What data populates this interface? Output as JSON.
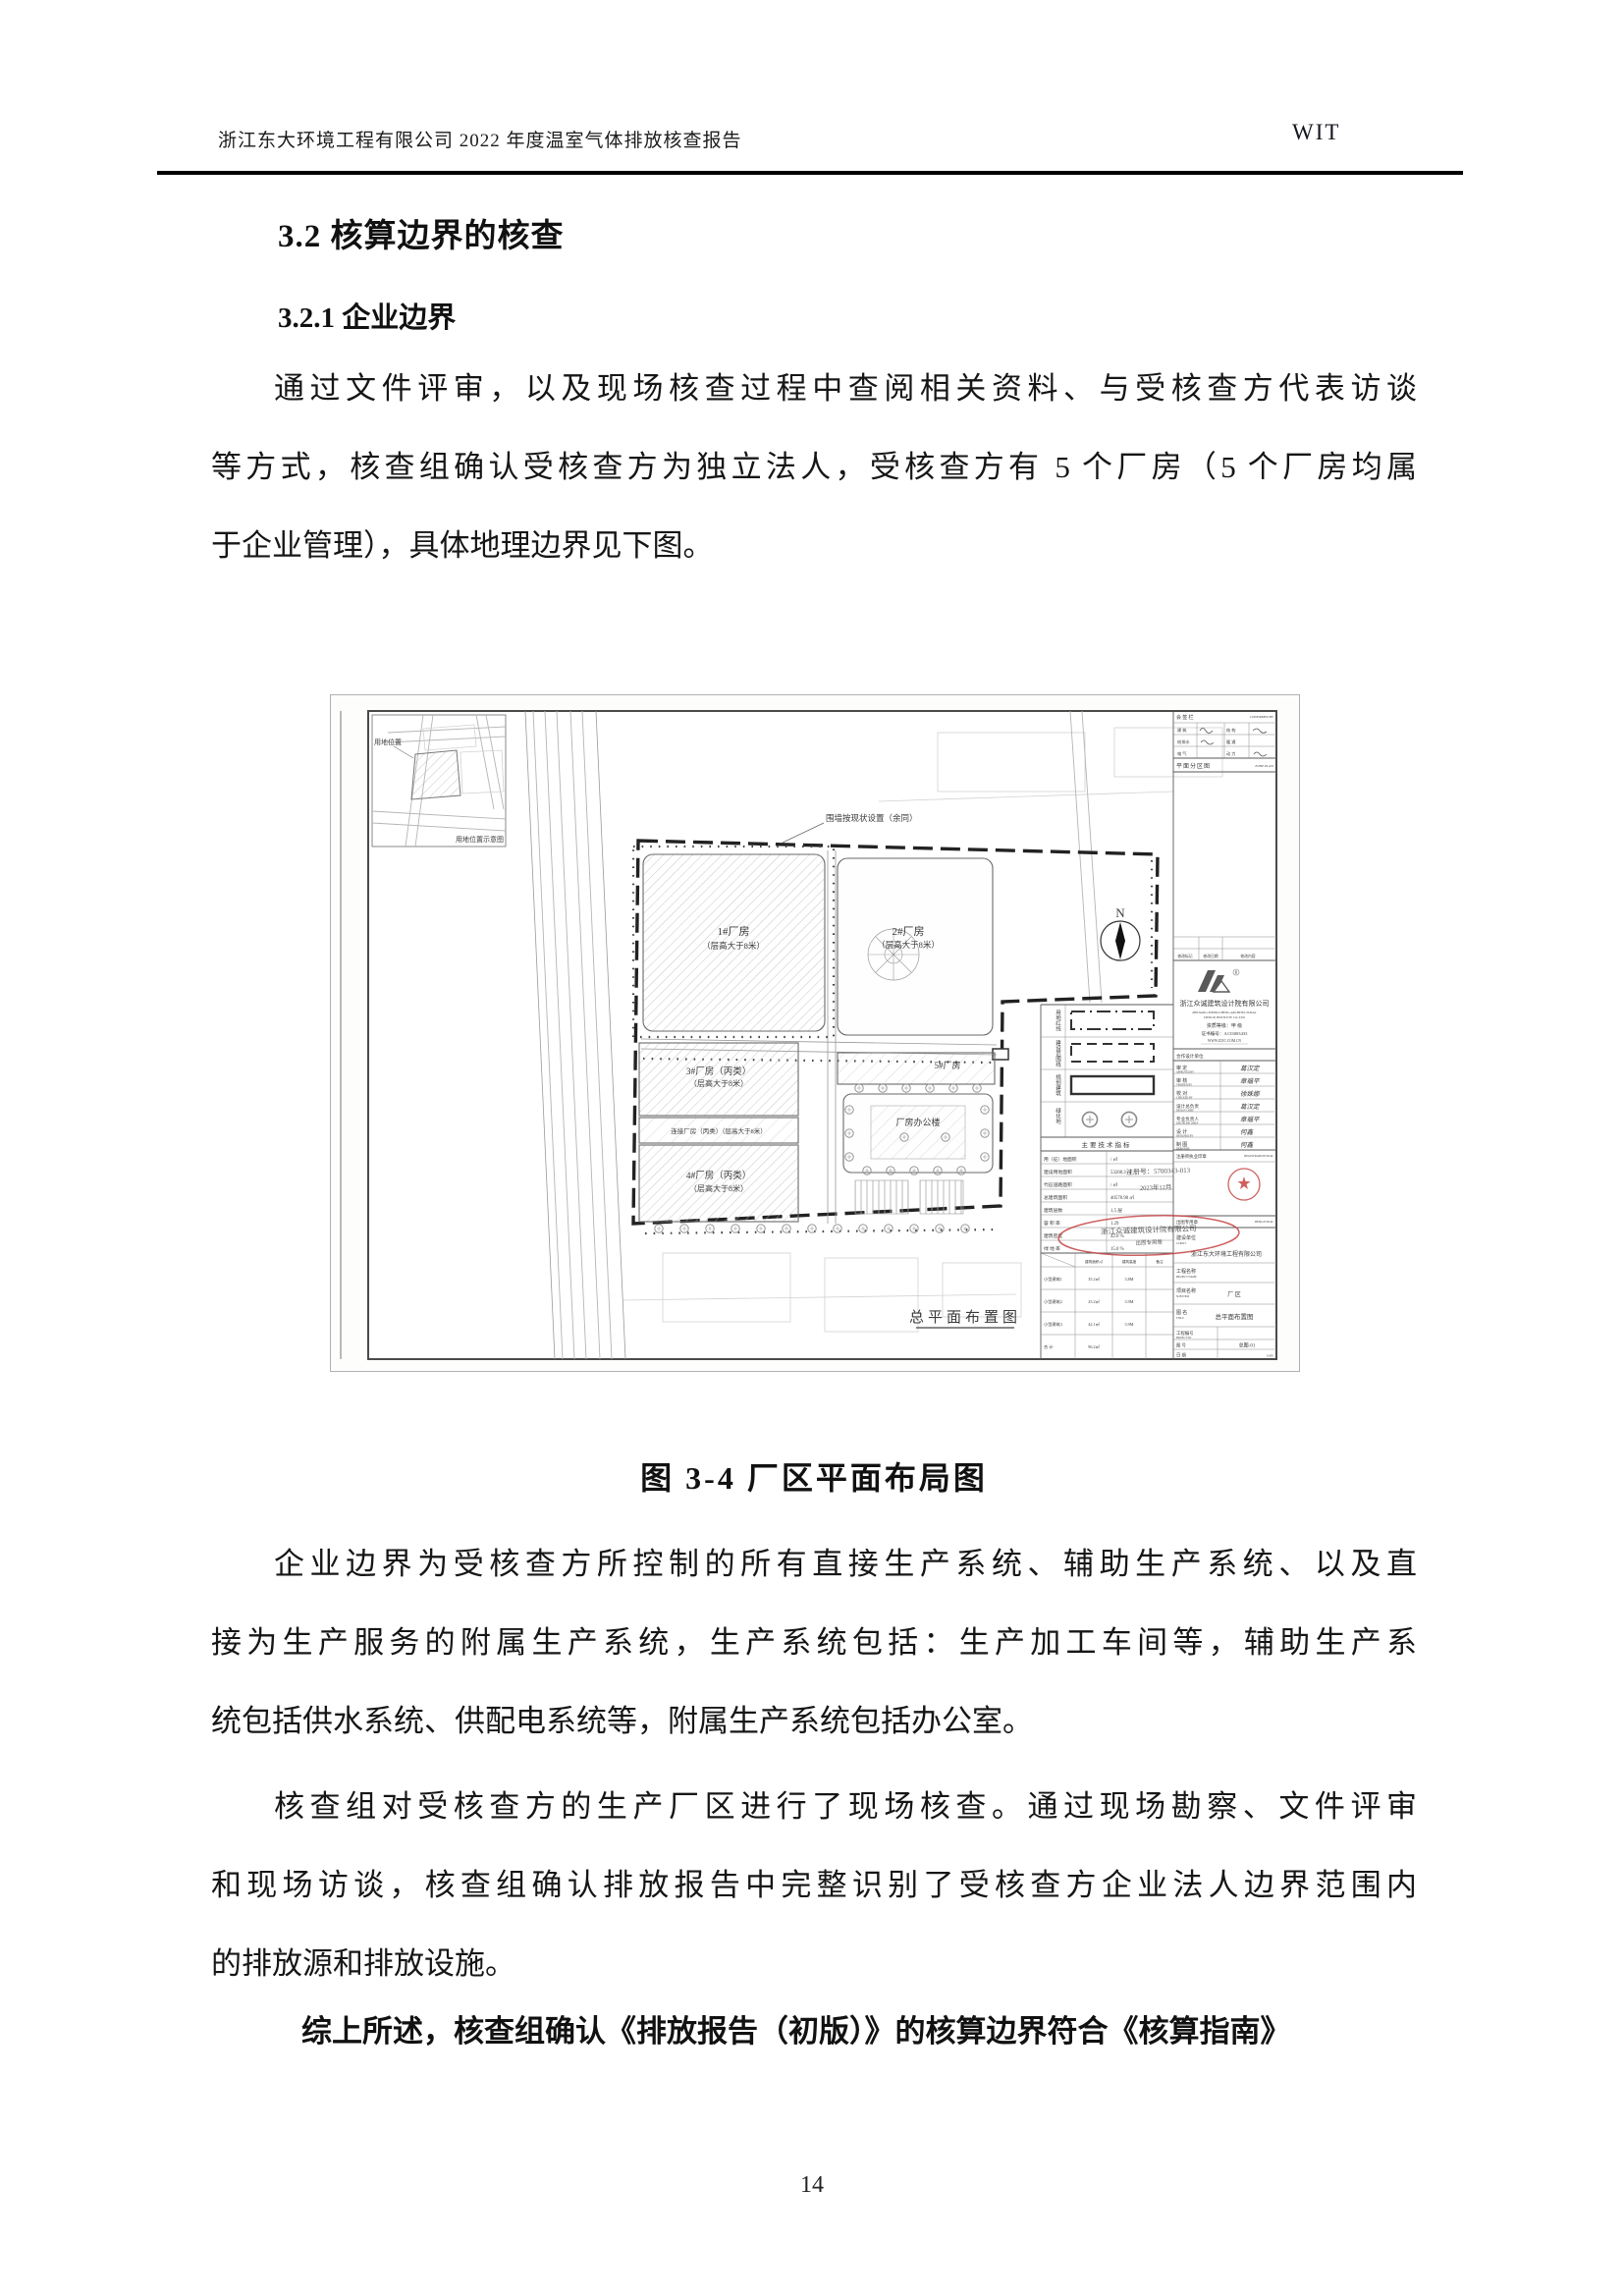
{
  "header": {
    "left": "浙江东大环境工程有限公司 2022 年度温室气体排放核查报告",
    "right": "WIT"
  },
  "sections": {
    "h1": "3.2 核算边界的核查",
    "h2": "3.2.1 企业边界"
  },
  "paragraphs": {
    "p1": [
      "通过文件评审，以及现场核查过程中查阅相关资料、与受核查方代表访谈",
      "等方式，核查组确认受核查方为独立法人，受核查方有 5 个厂房（5 个厂房均属",
      "于企业管理），具体地理边界见下图。"
    ],
    "caption": "图 3-4  厂区平面布局图",
    "p2": [
      "企业边界为受核查方所控制的所有直接生产系统、辅助生产系统、以及直",
      "接为生产服务的附属生产系统，生产系统包括：生产加工车间等，辅助生产系",
      "统包括供水系统、供配电系统等，附属生产系统包括办公室。"
    ],
    "p3": [
      "核查组对受核查方的生产厂区进行了现场核查。通过现场勘察、文件评审",
      "和现场访谈，核查组确认排放报告中完整识别了受核查方企业法人边界范围内",
      "的排放源和排放设施。"
    ],
    "p4": "综上所述，核查组确认《排放报告（初版）》的核算边界符合《核算指南》"
  },
  "page_number": "14",
  "figure": {
    "wall_note": "围墙按现状设置（余同）",
    "inset": {
      "label": "用地位置",
      "caption": "用地位置示意图"
    },
    "north": "N",
    "buildings": {
      "b1a": "1#厂房",
      "b1b": "（层高大于8米）",
      "b2a": "2#厂房",
      "b2b": "（层高大于8米）",
      "b3a": "3#厂房（丙类）",
      "b3b": "（层高大于8米）",
      "link": "连接厂房（丙类）（层高大于8米）",
      "b4a": "4#厂房（丙类）",
      "b4b": "（层高大于8米）",
      "b5": "5#厂房",
      "office": "厂房办公楼"
    },
    "plan_caption": "总平面布置图",
    "legend": [
      "用地红线",
      "建设范围线",
      "规划建筑",
      "绿化地"
    ],
    "tech_table": {
      "title": "主要技术指标",
      "rows": [
        [
          "用（征）地面积",
          "/ ㎡"
        ],
        [
          "建设用地面积",
          "53208.3 ㎡"
        ],
        [
          "代征道路面积",
          "/ ㎡"
        ],
        [
          "总建筑面积",
          "40578.98 ㎡"
        ],
        [
          "建筑层数",
          "1,5 层"
        ],
        [
          "容 积 率",
          "1.29"
        ],
        [
          "建筑密度",
          "42.6 %"
        ],
        [
          "绿 地 率",
          "15.0 %"
        ]
      ],
      "sub_header": [
        "建筑面积㎡",
        "建筑高度",
        "备注"
      ],
      "sub_rows": [
        [
          "小型建筑1",
          "35.2㎡",
          "3.8M"
        ],
        [
          "小型建筑2",
          "25.2㎡",
          "3.9M"
        ],
        [
          "小型建筑3",
          "42.1㎡",
          "3.9M"
        ],
        [
          "合 计",
          "96.2㎡",
          ""
        ]
      ]
    },
    "titleblock": {
      "confirm_cn": "会 签 栏",
      "confirm_en": "CONFIRMED BY",
      "grid": [
        "建 筑",
        "结 构",
        "给排水",
        "暖 通",
        "电 气",
        "动 力"
      ],
      "zone_cn": "平面分区图",
      "zone_en": "ZONE PLAN",
      "rev": [
        "修改标记",
        "修改日期",
        "修改内容"
      ],
      "company_cn": "浙江众诚建筑设计院有限公司",
      "company_en1": "ZHEJIANG ZHONGCHENG ARCHITECTURAL",
      "company_en2": "DESIGN INSTITUTE CO.,LTD",
      "grade": "资质等级：甲 级",
      "cert": "证书编号：A133003433",
      "web": "WWW.ZJZC.COM.CN",
      "coop": "合作设计单位",
      "sign_rows": [
        {
          "cn": "审 定",
          "en": "APPROVED BY",
          "name": "葛汉定"
        },
        {
          "cn": "审 核",
          "en": "VERIFIED BY",
          "name": "章福平"
        },
        {
          "cn": "校 对",
          "en": "CHECKED BY",
          "name": "徐姝娜"
        },
        {
          "cn": "设计总负责",
          "en": "DESIGN CHIEF",
          "name": "葛汉定"
        },
        {
          "cn": "专业负责人",
          "en": "DISCIPLINE CHIEF",
          "name": "章福平"
        },
        {
          "cn": "设 计",
          "en": "DESIGNED BY",
          "name": "何鑫"
        },
        {
          "cn": "制 图",
          "en": "DRAWN BY",
          "name": "何鑫"
        }
      ],
      "reg_cn": "注册师执业印章",
      "reg_en": "REGISTRATION SEAL",
      "seal_cn": "出图专用章",
      "seal_en": "DESIGN SEAL",
      "client_cn": "建设单位",
      "client_en": "CLIENT",
      "client_val": "浙江东大环境工程有限公司",
      "proj_cn": "工程名称",
      "proj_en": "PROJECT NAME",
      "sub_cn": "项目名称",
      "sub_en": "SUB ITEM",
      "sub_val": "厂 区",
      "title_cn": "图 名",
      "title_en": "TITLE",
      "title_val": "总平面布置图",
      "no_cn": "工程编号",
      "no_en": "PROJECT NO",
      "dwg_cn": "图 号",
      "dwg_en": "DWG NO",
      "dwg_val": "总图-01",
      "date_cn": "日 期",
      "date_en": "DATE"
    },
    "stamps": {
      "reg1": "注册号：5700343-013",
      "reg2": "2023年12月",
      "oval1": "浙江众诚建筑设计院有限公司",
      "oval2": "出图专用章"
    }
  }
}
